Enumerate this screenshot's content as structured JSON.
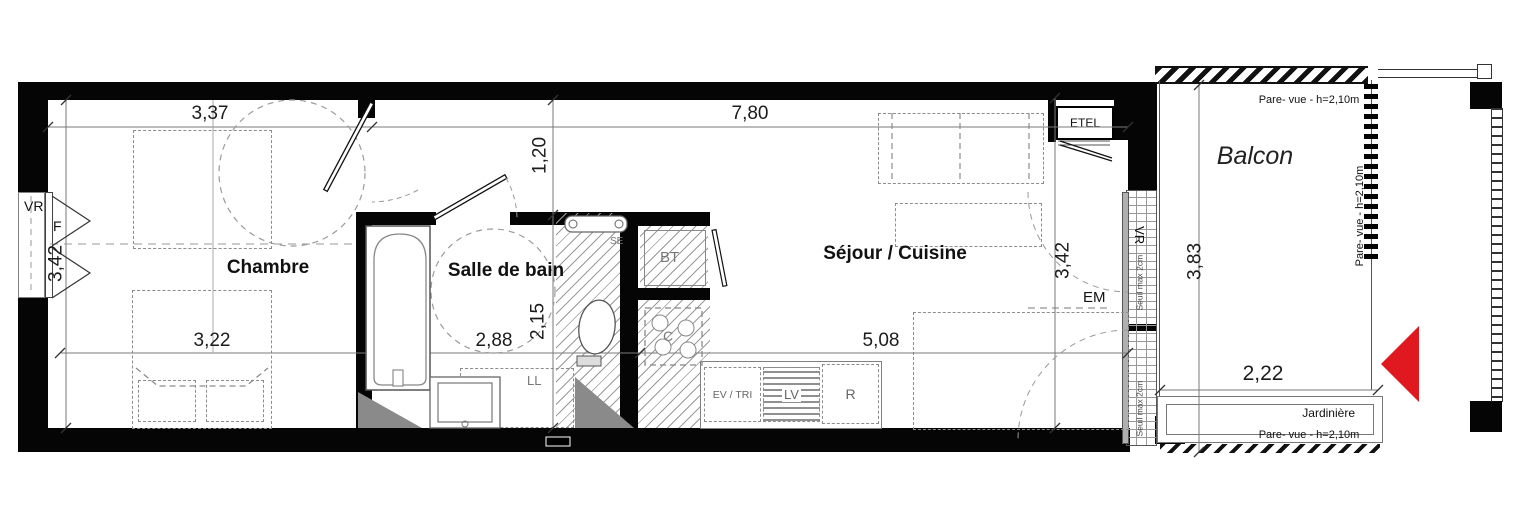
{
  "plan": {
    "rooms": {
      "bedroom": "Chambre",
      "bathroom": "Salle de bain",
      "living_kitchen": "Séjour / Cuisine",
      "balcony": "Balcon"
    },
    "dimensions": {
      "bedroom_width": "3,37",
      "living_width": "7,80",
      "entry_depth": "1,20",
      "left_depth": "3,42",
      "bedroom_inner_width": "3,22",
      "bathroom_width": "2,88",
      "bathroom_depth": "2,15",
      "kitchen_width": "5,08",
      "right_depth": "3,42",
      "balcony_depth": "3,83",
      "balcony_width": "2,22"
    },
    "equipment": {
      "roller_shutter_left": "VR",
      "window_left": "F",
      "electrical_closet": "ETEL",
      "em_unit": "EM",
      "roller_shutter_right": "VR",
      "threshold_upper": "Seuil max 2cm",
      "threshold_lower": "Seuil max 2cm",
      "towel_dryer": "SE",
      "hot_water_tank": "BT",
      "cooktop": "C",
      "washing_machine": "LL",
      "sink_sorting": "EV / TRI",
      "dishwasher": "LV",
      "fridge": "R"
    },
    "balcony_annotations": {
      "screen_top": "Pare- vue - h=2,10m",
      "screen_right": "Pare- vue - h=2,10m",
      "screen_bottom": "Pare- vue - h=2,10m",
      "planter": "Jardinière"
    },
    "colors": {
      "walls": "#050505",
      "entry_arrow": "#e01820",
      "dimension_text": "#1c1c1c",
      "hatch": "#9a9a9a"
    }
  }
}
